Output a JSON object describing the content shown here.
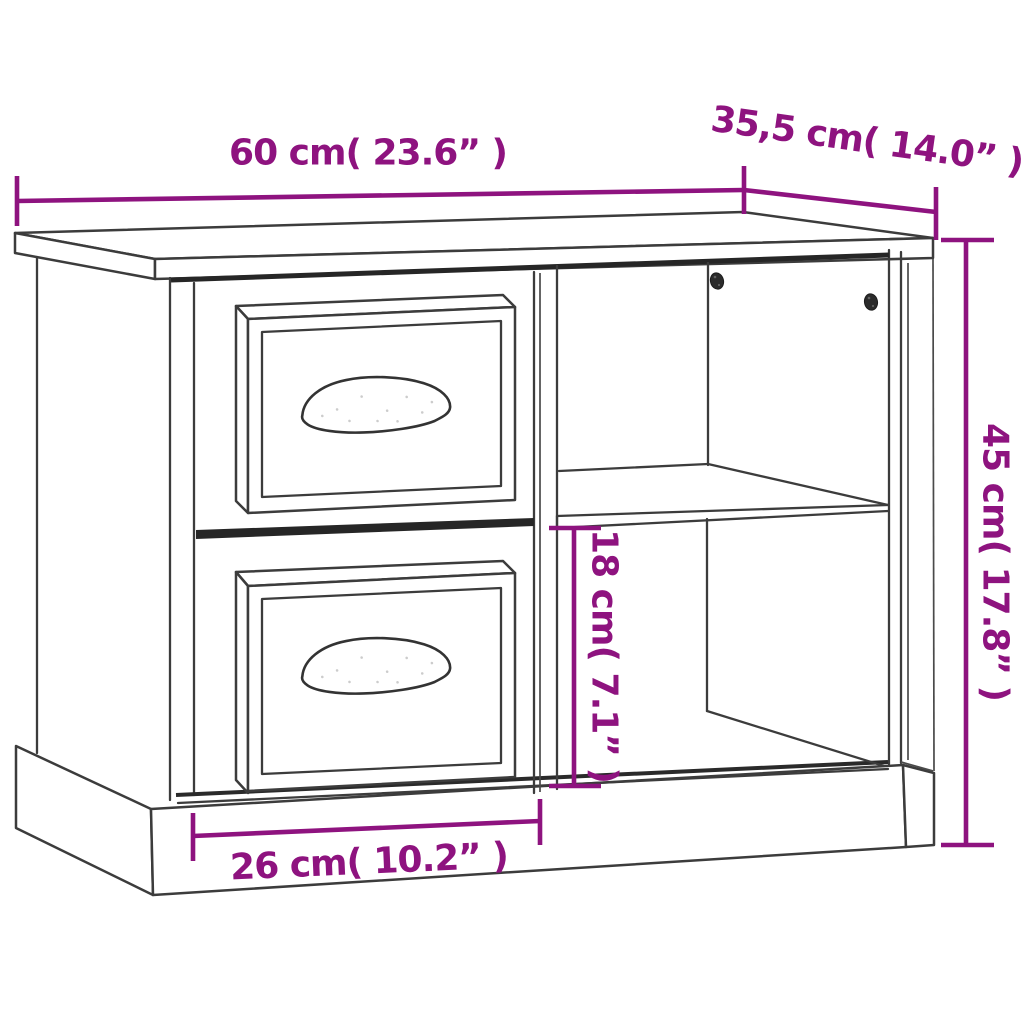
{
  "page": {
    "type": "product-dimension-diagram",
    "product": "bedside cabinet with two drawers and open shelf compartments"
  },
  "dimension_labels": {
    "width": "60 cm( 23.6” )",
    "depth": "35,5 cm( 14.0” )",
    "height": "45 cm( 17.8” )",
    "shelf_clearance": "18 cm( 7.1” )",
    "base_width": "26 cm( 10.2” )"
  },
  "dimension_values": {
    "width_cm": 60,
    "width_in": 23.6,
    "depth_cm": 35.5,
    "depth_in": 14.0,
    "height_cm": 45,
    "height_in": 17.8,
    "shelf_clearance_cm": 18,
    "shelf_clearance_in": 7.1,
    "base_width_cm": 26,
    "base_width_in": 10.2
  },
  "colors": {
    "dimension_accent": "#8E137F",
    "outline": "#3C3C3C",
    "background": "#FFFFFF"
  }
}
